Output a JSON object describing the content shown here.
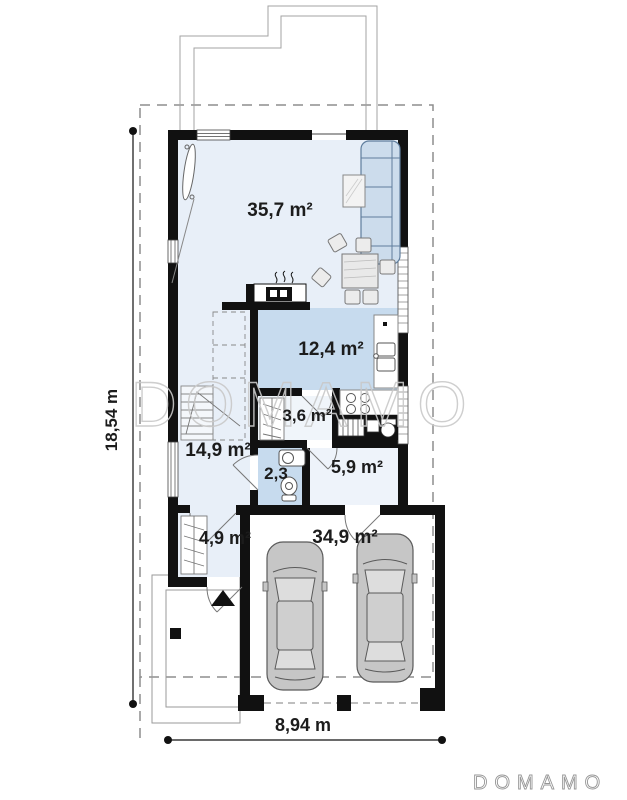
{
  "watermark": {
    "text": "DOMAMO"
  },
  "brand": {
    "logo_text": "DOMAMO"
  },
  "dimensions": {
    "overall_depth": "18,54 m",
    "overall_width": "8,94 m"
  },
  "rooms": {
    "living_room": {
      "area_label": "35,7 m²"
    },
    "kitchen": {
      "area_label": "12,4 m²"
    },
    "pantry": {
      "area_label": "3,6 m²"
    },
    "hall": {
      "area_label": "14,9 m²"
    },
    "wc": {
      "area_label": "2,3"
    },
    "utility": {
      "area_label": "5,9 m²"
    },
    "entry": {
      "area_label": "4,9 m²"
    },
    "garage": {
      "area_label": "34,9 m²"
    }
  },
  "colors": {
    "wall": "#111111",
    "floor_light": "#e8eff8",
    "floor_accent": "#c7dbee",
    "floor_pale": "#f0f5fa",
    "sofa_fill": "#ccdcec",
    "sofa_stroke": "#5f7d9d",
    "car_fill": "#c6c6c6",
    "watermark_stroke": "#c9c9c9",
    "logo_stroke": "#969696",
    "boundary_dash": "#8d8d8d",
    "roof_line": "#a3a3a3"
  }
}
